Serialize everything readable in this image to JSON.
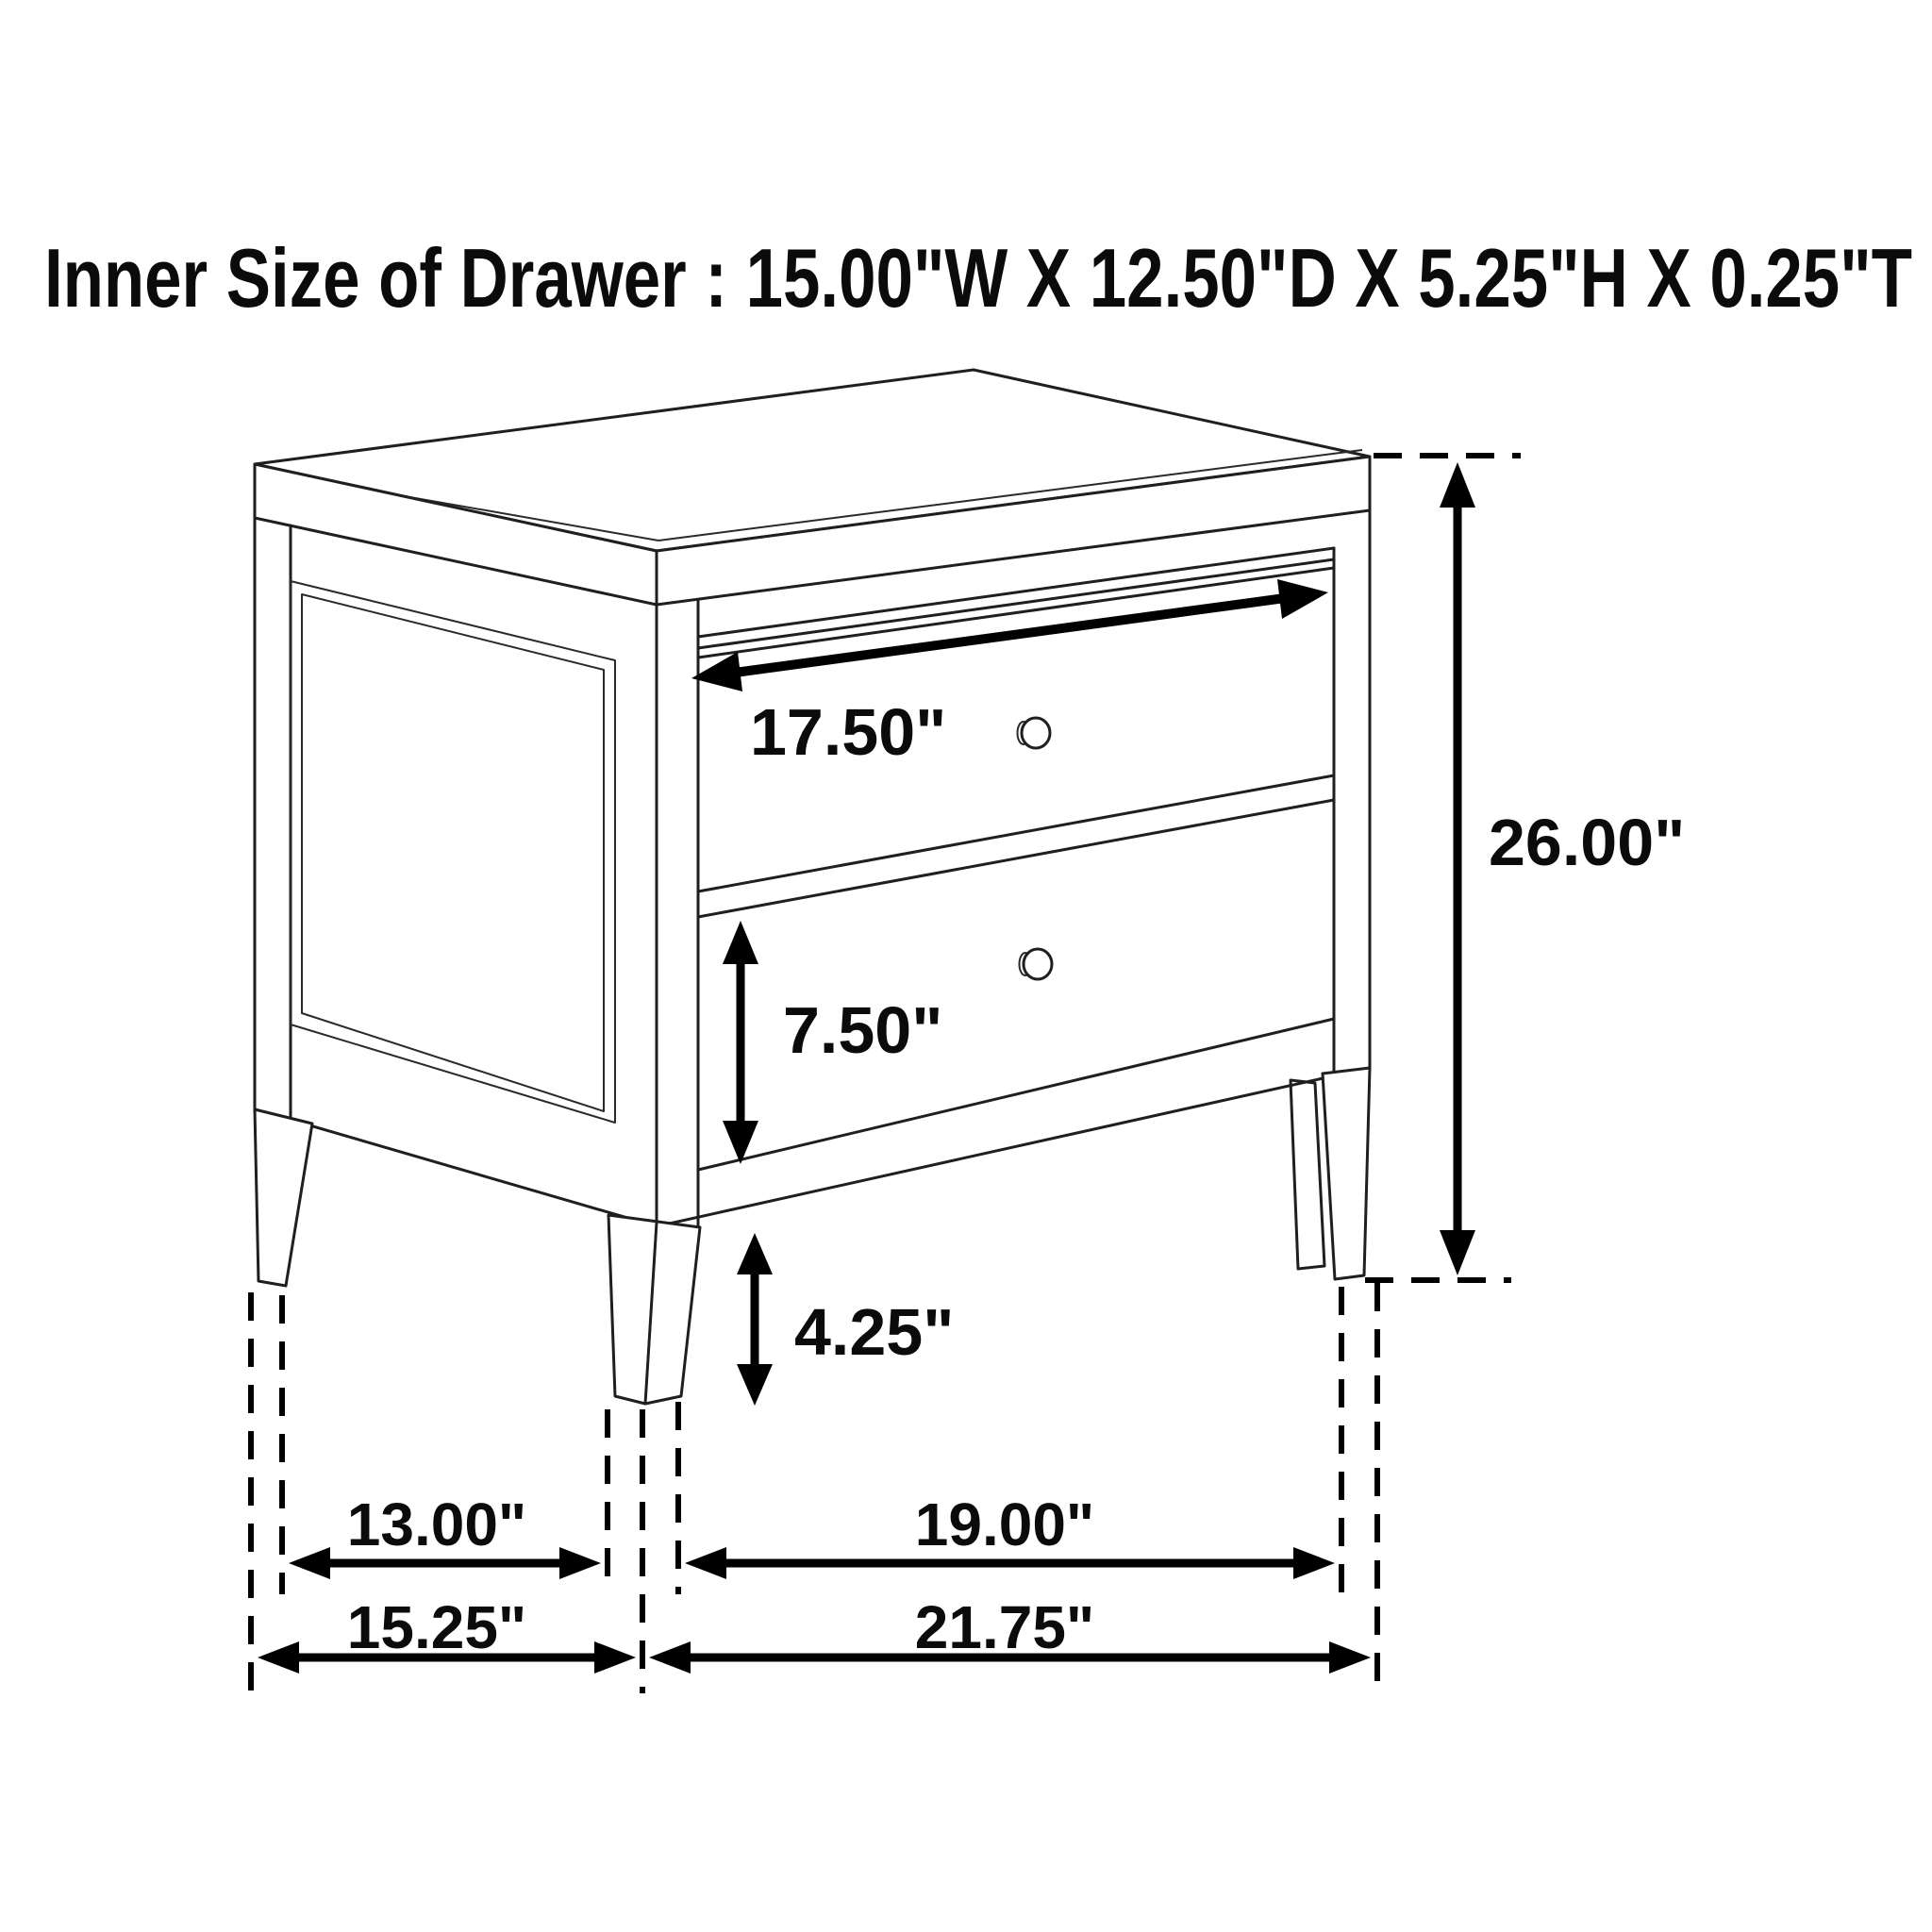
{
  "title": "Inner Size of Drawer : 15.00\"W X 12.50\"D X 5.25\"H X 0.25\"T",
  "inner_drawer_size": {
    "width": "15.00\"W",
    "depth": "12.50\"D",
    "height": "5.25\"H",
    "thickness": "0.25\"T"
  },
  "dimensions": {
    "drawer_opening_width": "17.50\"",
    "overall_height": "26.00\"",
    "drawer_front_height": "7.50\"",
    "leg_clearance_height": "4.25\"",
    "side_leg_span_inner": "13.00\"",
    "side_overall_depth": "15.25\"",
    "front_leg_span_inner": "19.00\"",
    "front_overall_width": "21.75\""
  },
  "colors": {
    "background": "#ffffff",
    "line": "#1f1f1f",
    "annotation": "#000000"
  }
}
